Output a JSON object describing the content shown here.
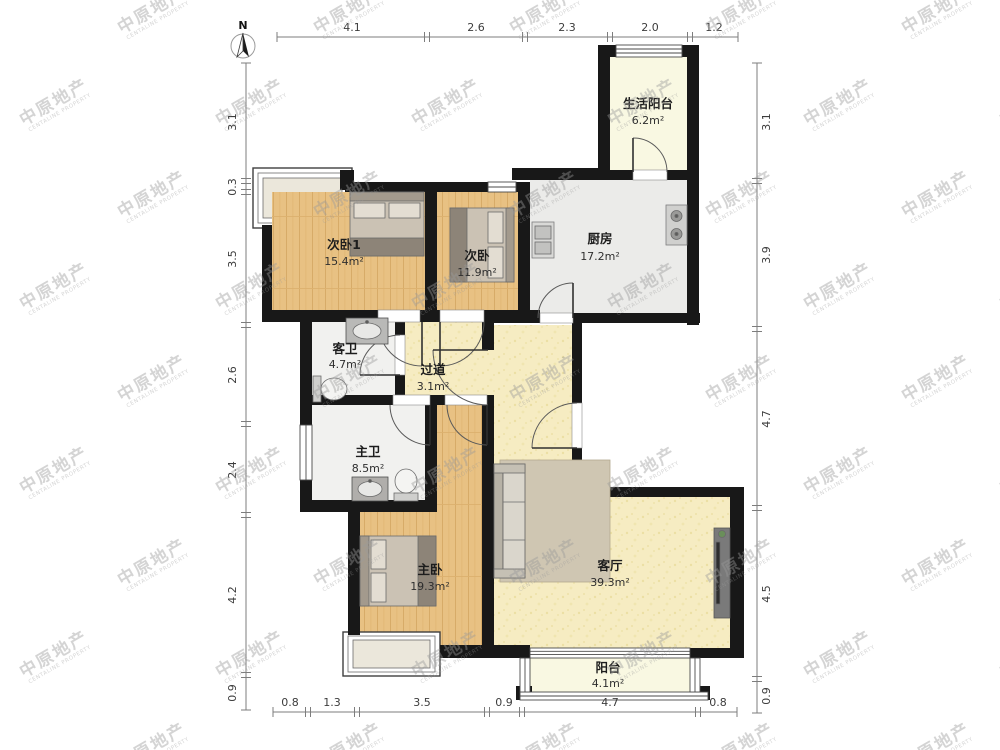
{
  "watermark": {
    "cn": "中原地产",
    "en": "CENTALINE PROPERTY"
  },
  "compass": {
    "label": "N"
  },
  "dimensions": {
    "top": [
      "4.1",
      "2.6",
      "2.3",
      "2.0",
      "1.2"
    ],
    "left": [
      "3.1",
      "0.3",
      "3.5",
      "2.6",
      "2.4",
      "4.2",
      "0.9"
    ],
    "right": [
      "3.1",
      "3.9",
      "4.7",
      "4.5",
      "0.9"
    ],
    "bottom": [
      "0.8",
      "1.3",
      "3.5",
      "0.9",
      "4.7",
      "0.8"
    ]
  },
  "rooms": {
    "service_balcony": {
      "name": "生活阳台",
      "area": "6.2m²"
    },
    "kitchen": {
      "name": "厨房",
      "area": "17.2m²"
    },
    "bedroom2_1": {
      "name": "次卧1",
      "area": "15.4m²"
    },
    "bedroom2": {
      "name": "次卧",
      "area": "11.9m²"
    },
    "guest_bath": {
      "name": "客卫",
      "area": "4.7m²"
    },
    "hallway": {
      "name": "过道",
      "area": "3.1m²"
    },
    "master_bath": {
      "name": "主卫",
      "area": "8.5m²"
    },
    "master_bedroom": {
      "name": "主卧",
      "area": "19.3m²"
    },
    "living_room": {
      "name": "客厅",
      "area": "39.3m²"
    },
    "balcony": {
      "name": "阳台",
      "area": "4.1m²"
    }
  },
  "colors": {
    "wall": "#181818",
    "wood_floor": "#e8c183",
    "tile_pale_yellow": "#f6ecc2",
    "kitchen_gray": "#ebebe9",
    "bath_gray": "#f1f1ef",
    "balcony_cream": "#f9f8e2",
    "dimension_line": "#777777",
    "watermark_gray": "#9a9a9a"
  }
}
